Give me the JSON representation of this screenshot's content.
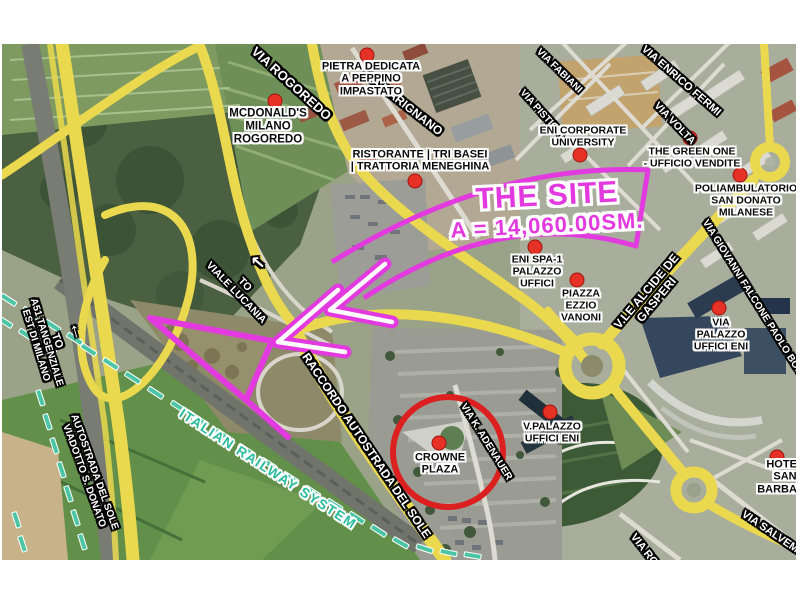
{
  "site_callout": {
    "title": "THE SITE",
    "area": "A = 14,060.00SM."
  },
  "railway_label": "ITALIAN RAILWAY SYSTEM",
  "pois": [
    {
      "id": "pietra-dedicata",
      "label": "PIETRA DEDICATA\nA PEPPINO\nIMPASTATO"
    },
    {
      "id": "mcdonalds-milano-rogoredo",
      "label": "MCDONALD'S\nMILANO\nROGOREDO"
    },
    {
      "id": "ristorante-tri-basei",
      "label": "RISTORANTE | TRI BASEI\n| TRATTORIA MENEGHINA"
    },
    {
      "id": "eni-corporate-university",
      "label": "ENI CORPORATE\nUNIVERSITY"
    },
    {
      "id": "the-green-one",
      "label": "THE GREEN ONE\n- UFFICIO VENDITE"
    },
    {
      "id": "poliambulatorio-san-donato",
      "label": "POLIAMBULATORIO\nSAN DONATO\nMILANESE"
    },
    {
      "id": "eni-spa-1",
      "label": "ENI SPA-1\nPALAZZO\nUFFICI"
    },
    {
      "id": "piazza-ezzio-vanoni",
      "label": "PIAZZA\nEZZIO\nVANONI"
    },
    {
      "id": "via-palazzo-uffici-eni",
      "label": "VIA\nPALAZZO\nUFFICI ENI"
    },
    {
      "id": "v-palazzo-uffici-eni",
      "label": "V.PALAZZO\nUFFICI ENI"
    },
    {
      "id": "crowne-plaza",
      "label": "CROWNE\nPLAZA"
    },
    {
      "id": "hotel-san-barbara",
      "label": "HOTEL SAN\nBARBARA"
    }
  ],
  "roads": [
    {
      "id": "via-rogoredo",
      "label": "VIA ROGOREDO"
    },
    {
      "id": "via-marignano",
      "label": "VIA MARIGNANO"
    },
    {
      "id": "via-fabiani",
      "label": "VIA FABIANI"
    },
    {
      "id": "via-pisticci",
      "label": "VIA PISTICCI"
    },
    {
      "id": "via-enrico-fermi",
      "label": "VIA ENRICO FERMI"
    },
    {
      "id": "via-volta",
      "label": "VIA VOLTA"
    },
    {
      "id": "vle-alcide-de-gasperi",
      "label": "V.LE ALCIDE DE GASPERI"
    },
    {
      "id": "via-giovanni-falcone",
      "label": "VIA GIOVANNI FALCONE PAOLO BORSELLINO"
    },
    {
      "id": "raccordo-autostrada-del-sole",
      "label": "RACCORDO AUTOSTRADA DEL SOLE"
    },
    {
      "id": "a51-tangenziale",
      "label": "A51 TANGENZIALE\nEST DI MILANO"
    },
    {
      "id": "autostrada-del-sole-viadotto",
      "label": "AUTOSTRADA DEL SOLE\nVIADOTTO S. DONATO"
    },
    {
      "id": "via-k-adenauer",
      "label": "VIA K. ADENAUER"
    },
    {
      "id": "via-salvemini",
      "label": "VIA SALVEM"
    },
    {
      "id": "via-ro",
      "label": "VIA RO"
    }
  ],
  "directions": [
    {
      "id": "to-north",
      "label": "TO",
      "arrow": "↑"
    },
    {
      "id": "to-viale-lucania",
      "label": "TO\nVIALE LUCANIA",
      "arrow": "↖"
    }
  ],
  "colors": {
    "annotation_magenta": "#e33ae0",
    "marker_red": "#e53126",
    "circle_red": "#dc1f1f",
    "road_yellow": "#ead94e",
    "railway_teal": "#4cc5a5"
  }
}
